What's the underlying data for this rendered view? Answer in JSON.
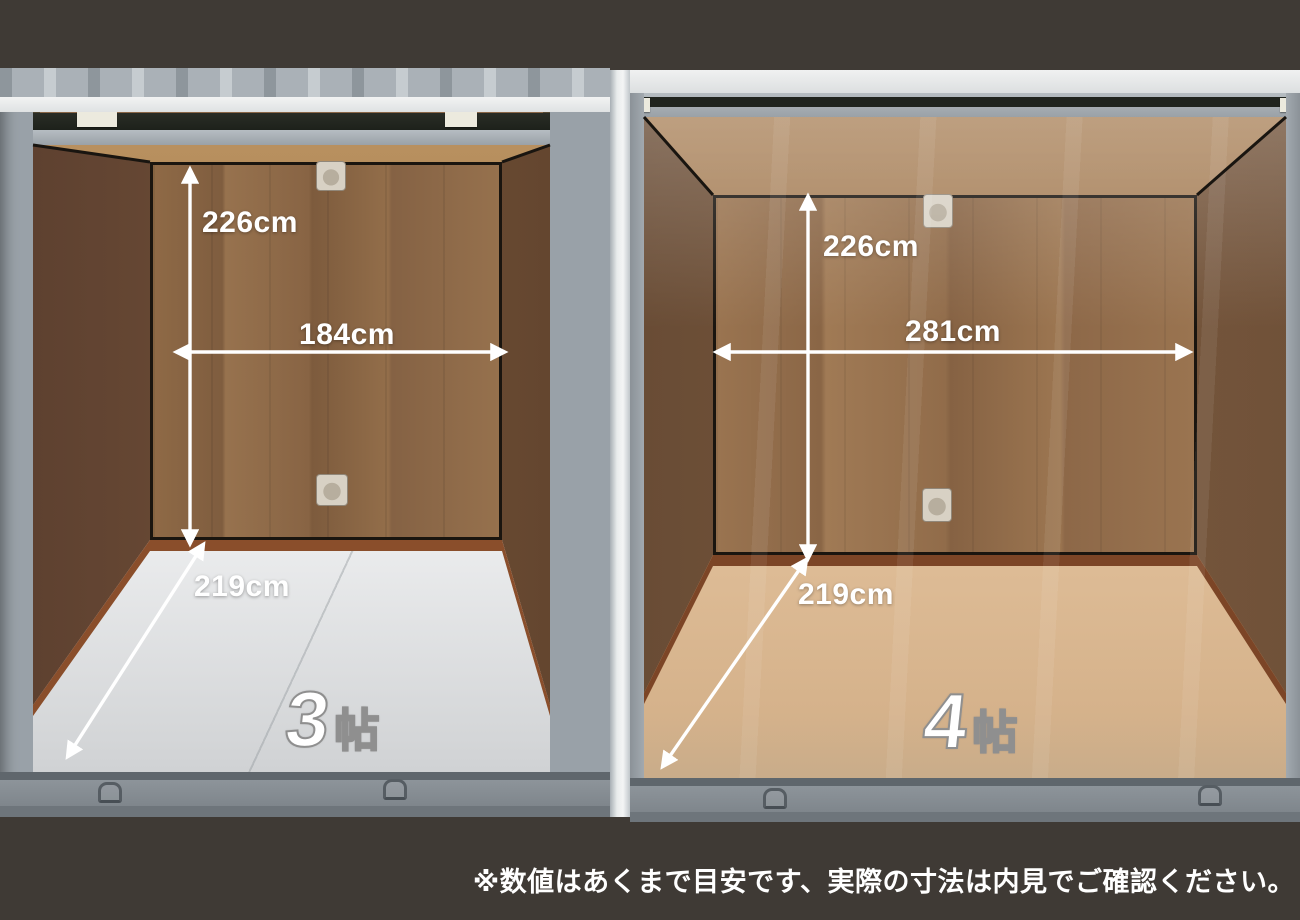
{
  "page": {
    "background_color": "#3f3a35",
    "disclaimer": "※数値はあくまで目安です、実際の寸法は内見でご確認ください。"
  },
  "units": [
    {
      "size_number": "3",
      "size_unit": "帖",
      "height_label": "226cm",
      "width_label": "184cm",
      "depth_label": "219cm",
      "floor_color": "#e9eaec",
      "wood_color": "#8a6647"
    },
    {
      "size_number": "4",
      "size_unit": "帖",
      "height_label": "226cm",
      "width_label": "281cm",
      "depth_label": "219cm",
      "floor_color": "#e0bd97",
      "wood_color": "#95714e"
    }
  ],
  "colors": {
    "annotation_text": "#ffffff",
    "frame_gray": "#9aa2a8",
    "corner_trim_dark": "#1a150f",
    "skirting_brown": "#84492a",
    "size_label_outline": "#8f8f8f"
  }
}
